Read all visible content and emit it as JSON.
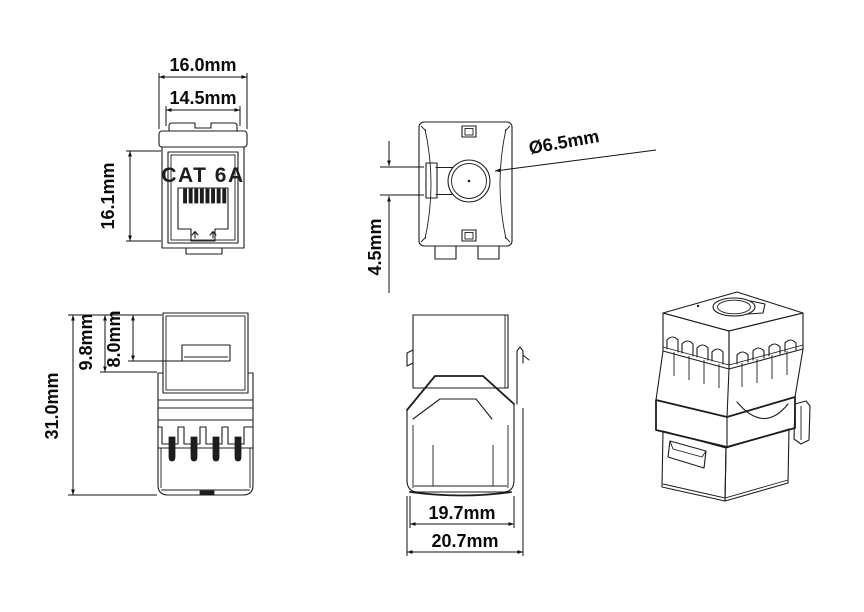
{
  "colors": {
    "background": "#ffffff",
    "line": "#1d1d1d",
    "text": "#0b0b0b"
  },
  "front_view": {
    "product_label": "CAT 6A",
    "dim_cap_width": "16.0mm",
    "dim_body_width": "14.5mm",
    "dim_face_height": "16.1mm"
  },
  "top_view": {
    "dim_hole_diameter": "Ø6.5mm",
    "dim_slot_offset": "4.5mm"
  },
  "side_view": {
    "dim_total_depth": "31.0mm",
    "dim_front_depth": "9.8mm",
    "dim_window_offset": "8.0mm"
  },
  "rear_view": {
    "dim_inner_width": "19.7mm",
    "dim_overall_width": "20.7mm"
  }
}
